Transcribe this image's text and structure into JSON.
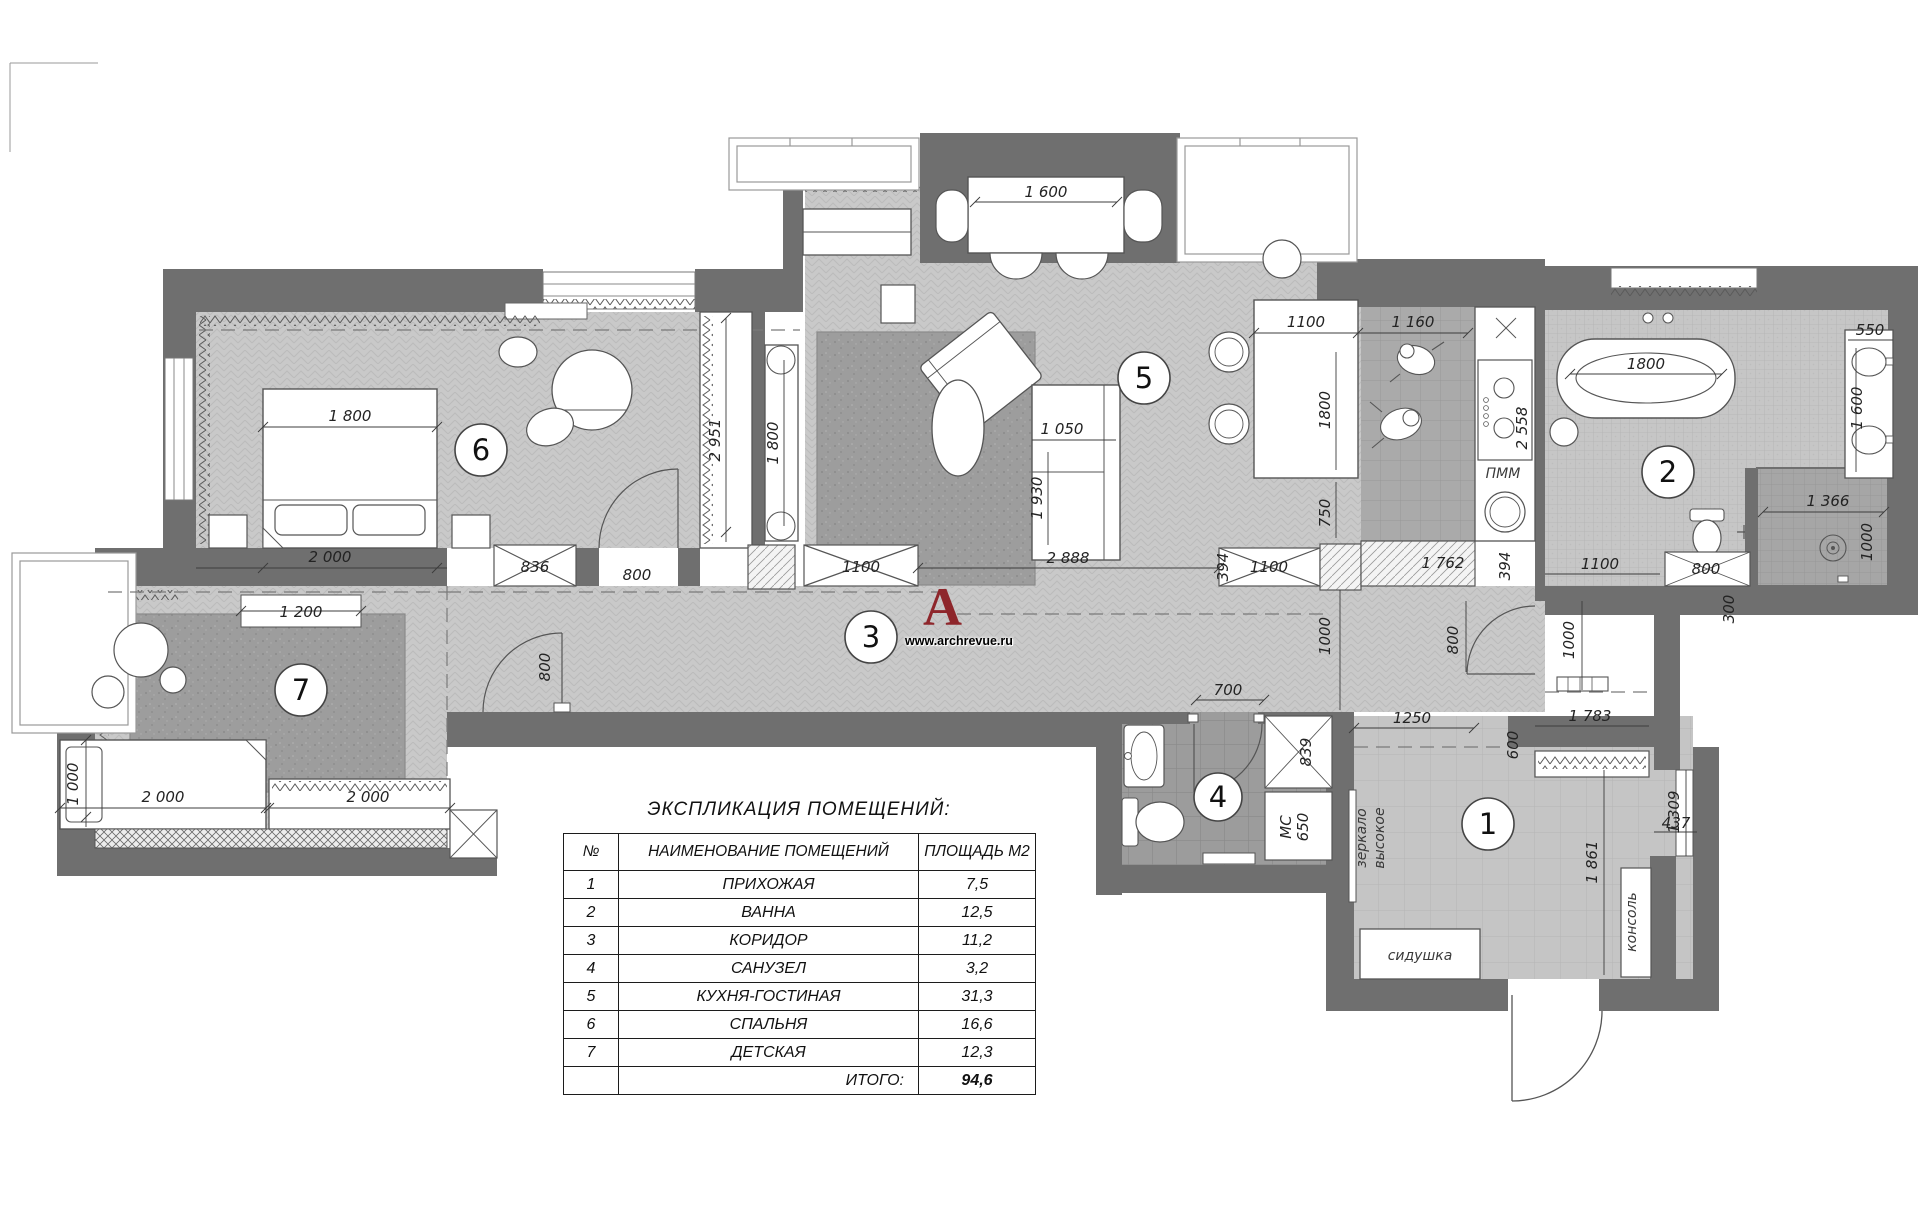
{
  "logo": {
    "letter": "A",
    "url": "www.archrevue.ru"
  },
  "legend": {
    "title": "ЭКСПЛИКАЦИЯ ПОМЕЩЕНИЙ:",
    "col_num": "№",
    "col_name": "НАИМЕНОВАНИЕ ПОМЕЩЕНИЙ",
    "col_area": "ПЛОЩАДЬ М2",
    "rows": [
      {
        "n": "1",
        "name": "ПРИХОЖАЯ",
        "area": "7,5"
      },
      {
        "n": "2",
        "name": "ВАННА",
        "area": "12,5"
      },
      {
        "n": "3",
        "name": "КОРИДОР",
        "area": "11,2"
      },
      {
        "n": "4",
        "name": "САНУЗЕЛ",
        "area": "3,2"
      },
      {
        "n": "5",
        "name": "КУХНЯ-ГОСТИНАЯ",
        "area": "31,3"
      },
      {
        "n": "6",
        "name": "СПАЛЬНЯ",
        "area": "16,6"
      },
      {
        "n": "7",
        "name": "ДЕТСКАЯ",
        "area": "12,3"
      }
    ],
    "total_label": "ИТОГО:",
    "total_value": "94,6"
  },
  "labels": {
    "pmm": "ПММ",
    "mc": "МС",
    "mirror_line1": "зеркало",
    "mirror_line2": "высокое",
    "seat": "сидушка",
    "console": "консоль"
  },
  "dims": {
    "bed_w": "1 800",
    "bed_l": "2 000",
    "closet836": "836",
    "bed_door": "800",
    "ward2951": "2 951",
    "tv1800": "1 800",
    "rug1200": "1 200",
    "cbed_w": "1 000",
    "cbed_l": "2 000",
    "cward": "2 000",
    "cdoor": "800",
    "cl1100a": "1100",
    "c2888": "2 888",
    "cl1100b": "1100",
    "v394a": "394",
    "k1762": "1 762",
    "v394b": "394",
    "dining1600": "1 600",
    "sofa1050": "1 050",
    "sofa1930": "1 930",
    "i1100": "1100",
    "i1160": "1 160",
    "i1800": "1800",
    "i750": "750",
    "k2558": "2 558",
    "tub1800": "1800",
    "b550": "550",
    "b1600": "1 600",
    "sh1366": "1 366",
    "sh1000": "1000",
    "b1100": "1100",
    "b800": "800",
    "v300": "300",
    "c1000a": "1000",
    "c800": "800",
    "c1000b": "1000",
    "wc700": "700",
    "wc839": "839",
    "wc650": "650",
    "h1250": "1250",
    "h600": "600",
    "h1783": "1 783",
    "h1309": "1 309",
    "h437": "437",
    "h1861": "1 861"
  }
}
